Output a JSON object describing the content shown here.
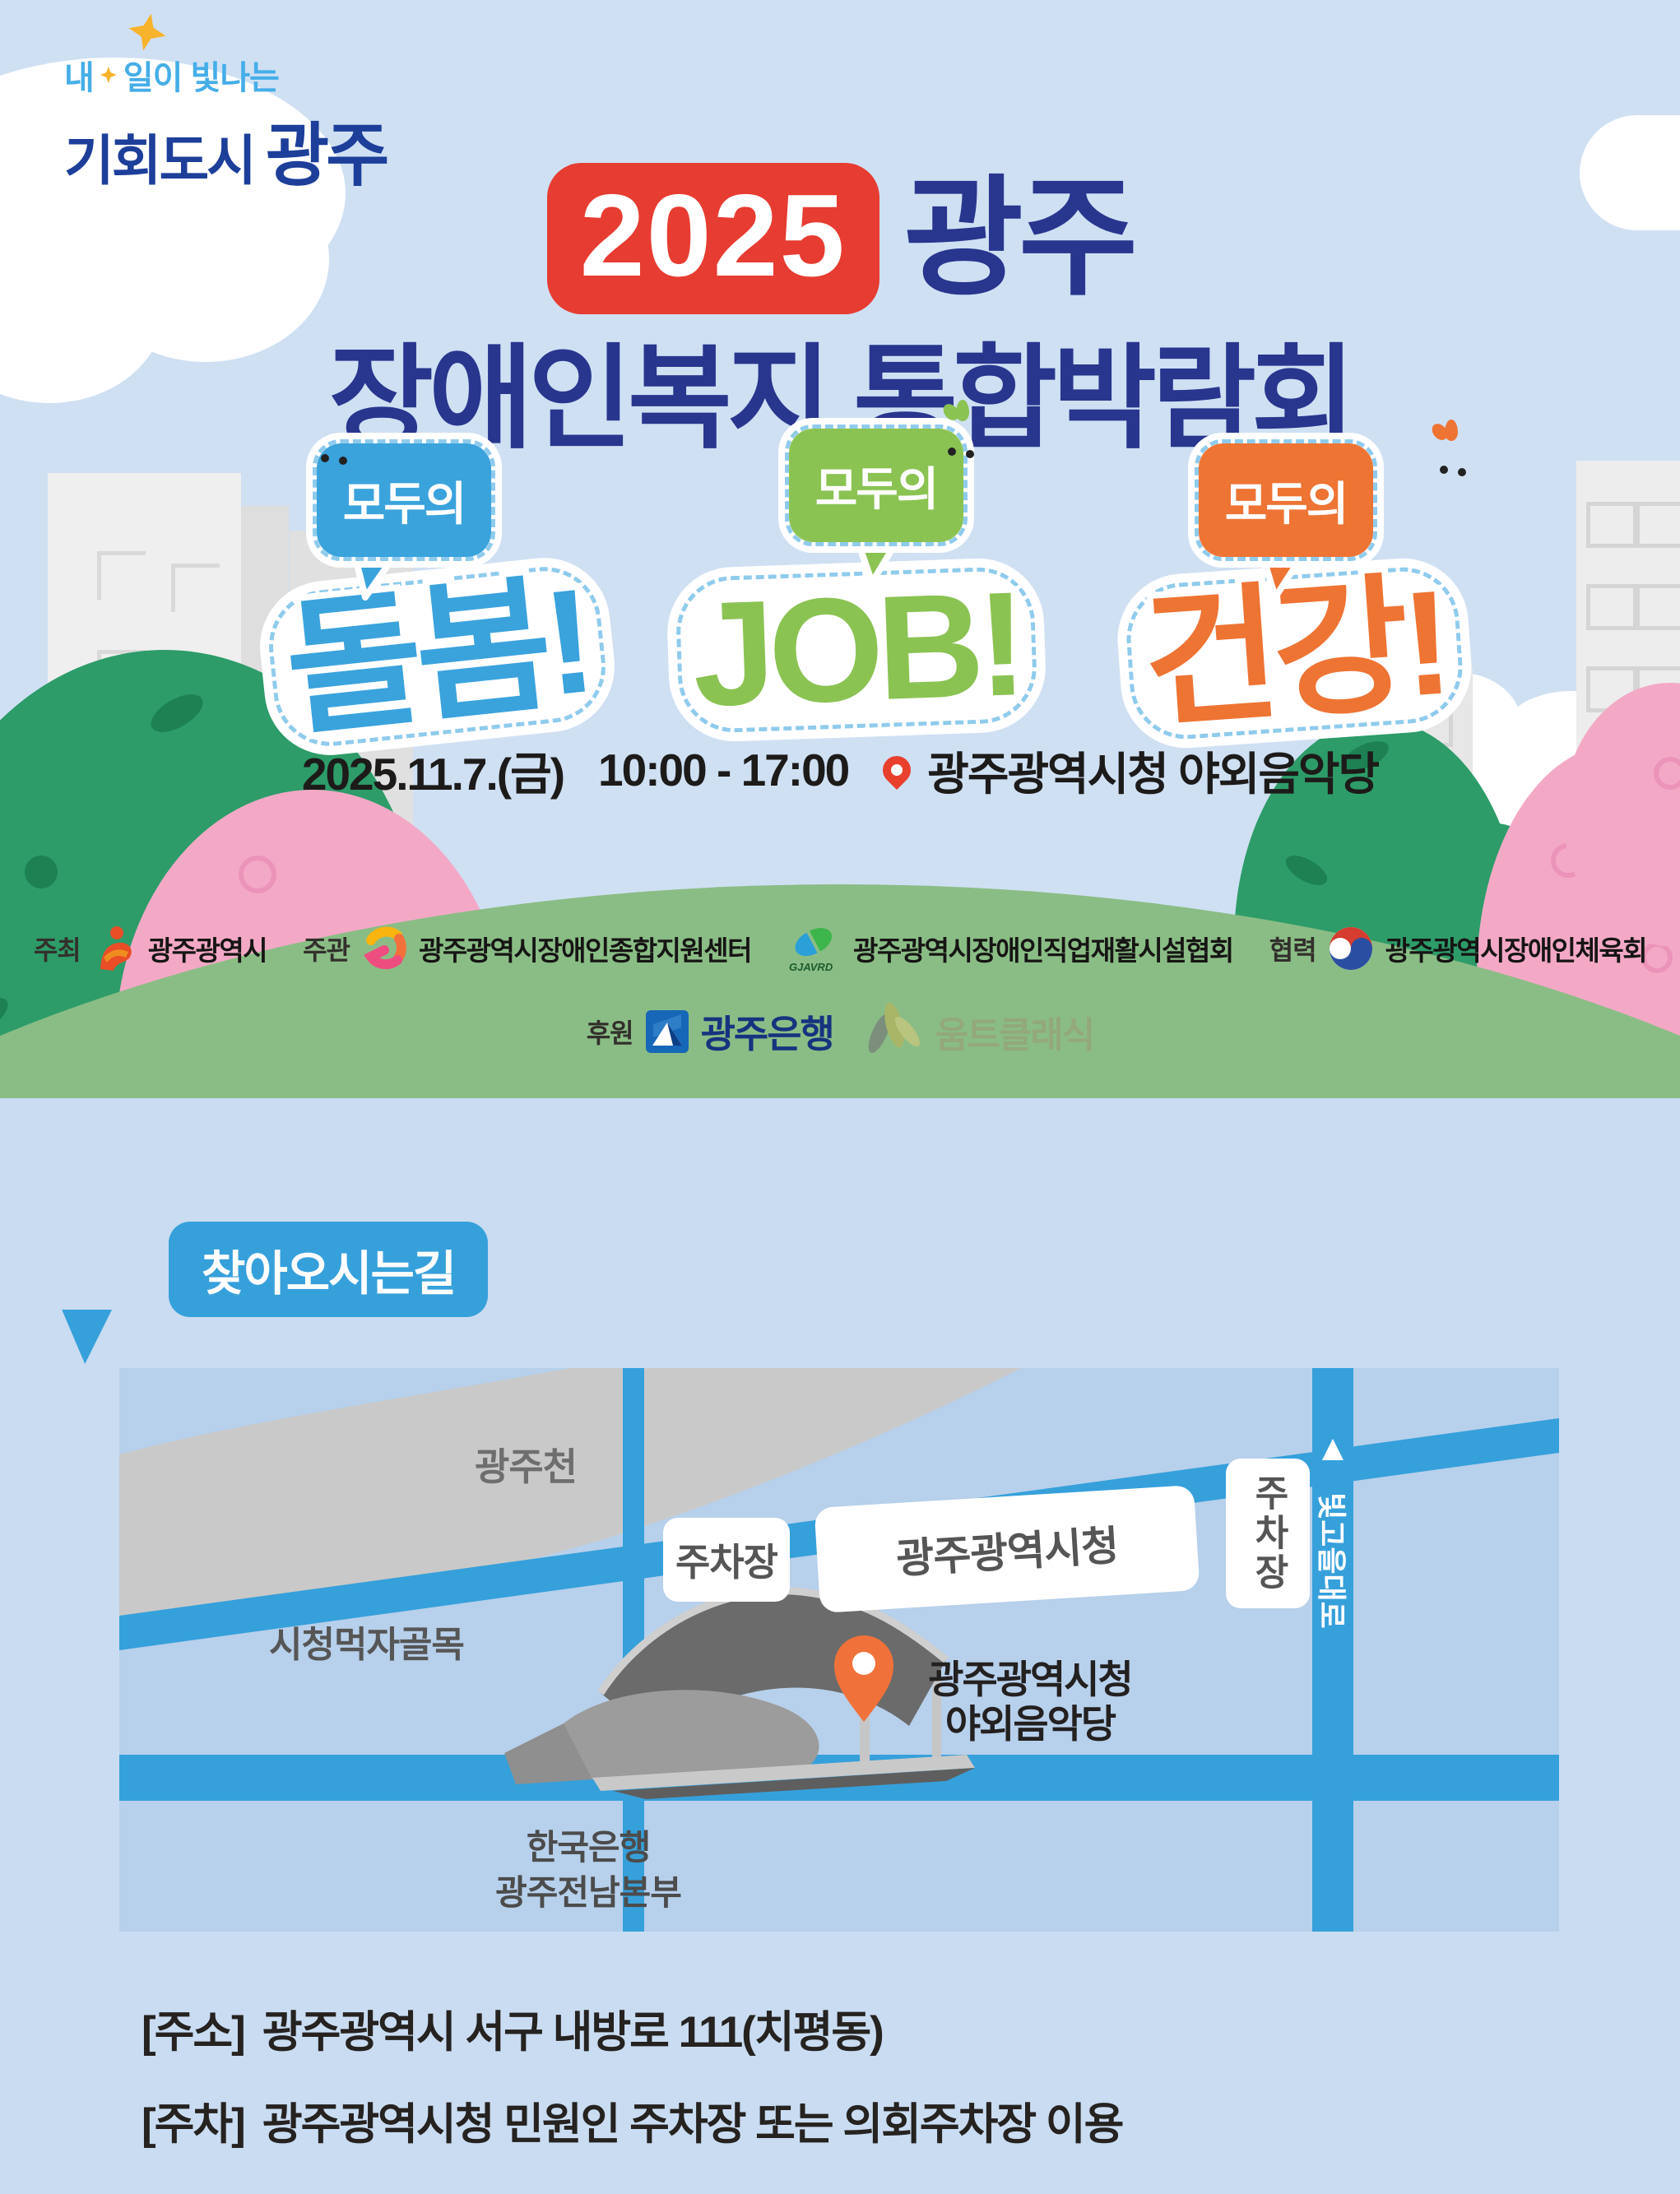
{
  "brand": {
    "tagline_prefix": "내",
    "tagline_suffix": "일이 빛나는",
    "line2_a": "기회도시",
    "line2_b": "광주"
  },
  "title": {
    "badge_year": "2025",
    "line1_city": "광주",
    "line2": "장애인복지 통합박람회"
  },
  "stickers": [
    {
      "bubble": "모두의",
      "word": "돌봄!"
    },
    {
      "bubble": "모두의",
      "word": "JOB!"
    },
    {
      "bubble": "모두의",
      "word": "건강!"
    }
  ],
  "event": {
    "date": "2025.11.7.(금)",
    "time": "10:00 - 17:00",
    "venue": "광주광역시청 야외음악당"
  },
  "organizers": {
    "host_label": "주최",
    "host_name": "광주광역시",
    "organize_label": "주관",
    "organizer1_name": "광주광역시장애인종합지원센터",
    "organizer2_logo_text": "GJAVRD",
    "organizer2_name": "광주광역시장애인직업재활시설협회",
    "coop_label": "협력",
    "coop_name": "광주광역시장애인체육회",
    "sponsor_label": "후원",
    "sponsor1_name": "광주은행",
    "sponsor2_name": "움트클래식"
  },
  "directions": {
    "heading": "찾아오시는길"
  },
  "map": {
    "river_label": "광주천",
    "alley_label": "시청먹자골목",
    "parking_box1": "주차장",
    "cityhall_box": "광주광역시청",
    "parking_box2": "주차장",
    "boulevard_label": "빛고을대로",
    "venue_label_line1": "광주광역시청",
    "venue_label_line2": "야외음악당",
    "bank_label_line1": "한국은행",
    "bank_label_line2": "광주전남본부"
  },
  "footer": {
    "address_label": "[주소]",
    "address_text": "광주광역시 서구 내방로 111(치평동)",
    "parking_label": "[주차]",
    "parking_text": "광주광역시청 민원인 주차장 또는 의회주차장 이용"
  },
  "colors": {
    "sky": "#cfe0f3",
    "lower_bg": "#c9dcf1",
    "hill_green": "#8abd85",
    "map_bg": "#b7d0eb",
    "road_blue": "#36a0db",
    "river_gray": "#c9c9c9",
    "title_navy": "#28368e",
    "badge_red": "#e73c31",
    "sticker_blue": "#3aa3dc",
    "sticker_green": "#8bc353",
    "sticker_orange": "#ee7434",
    "pin_orange": "#f0713a"
  }
}
